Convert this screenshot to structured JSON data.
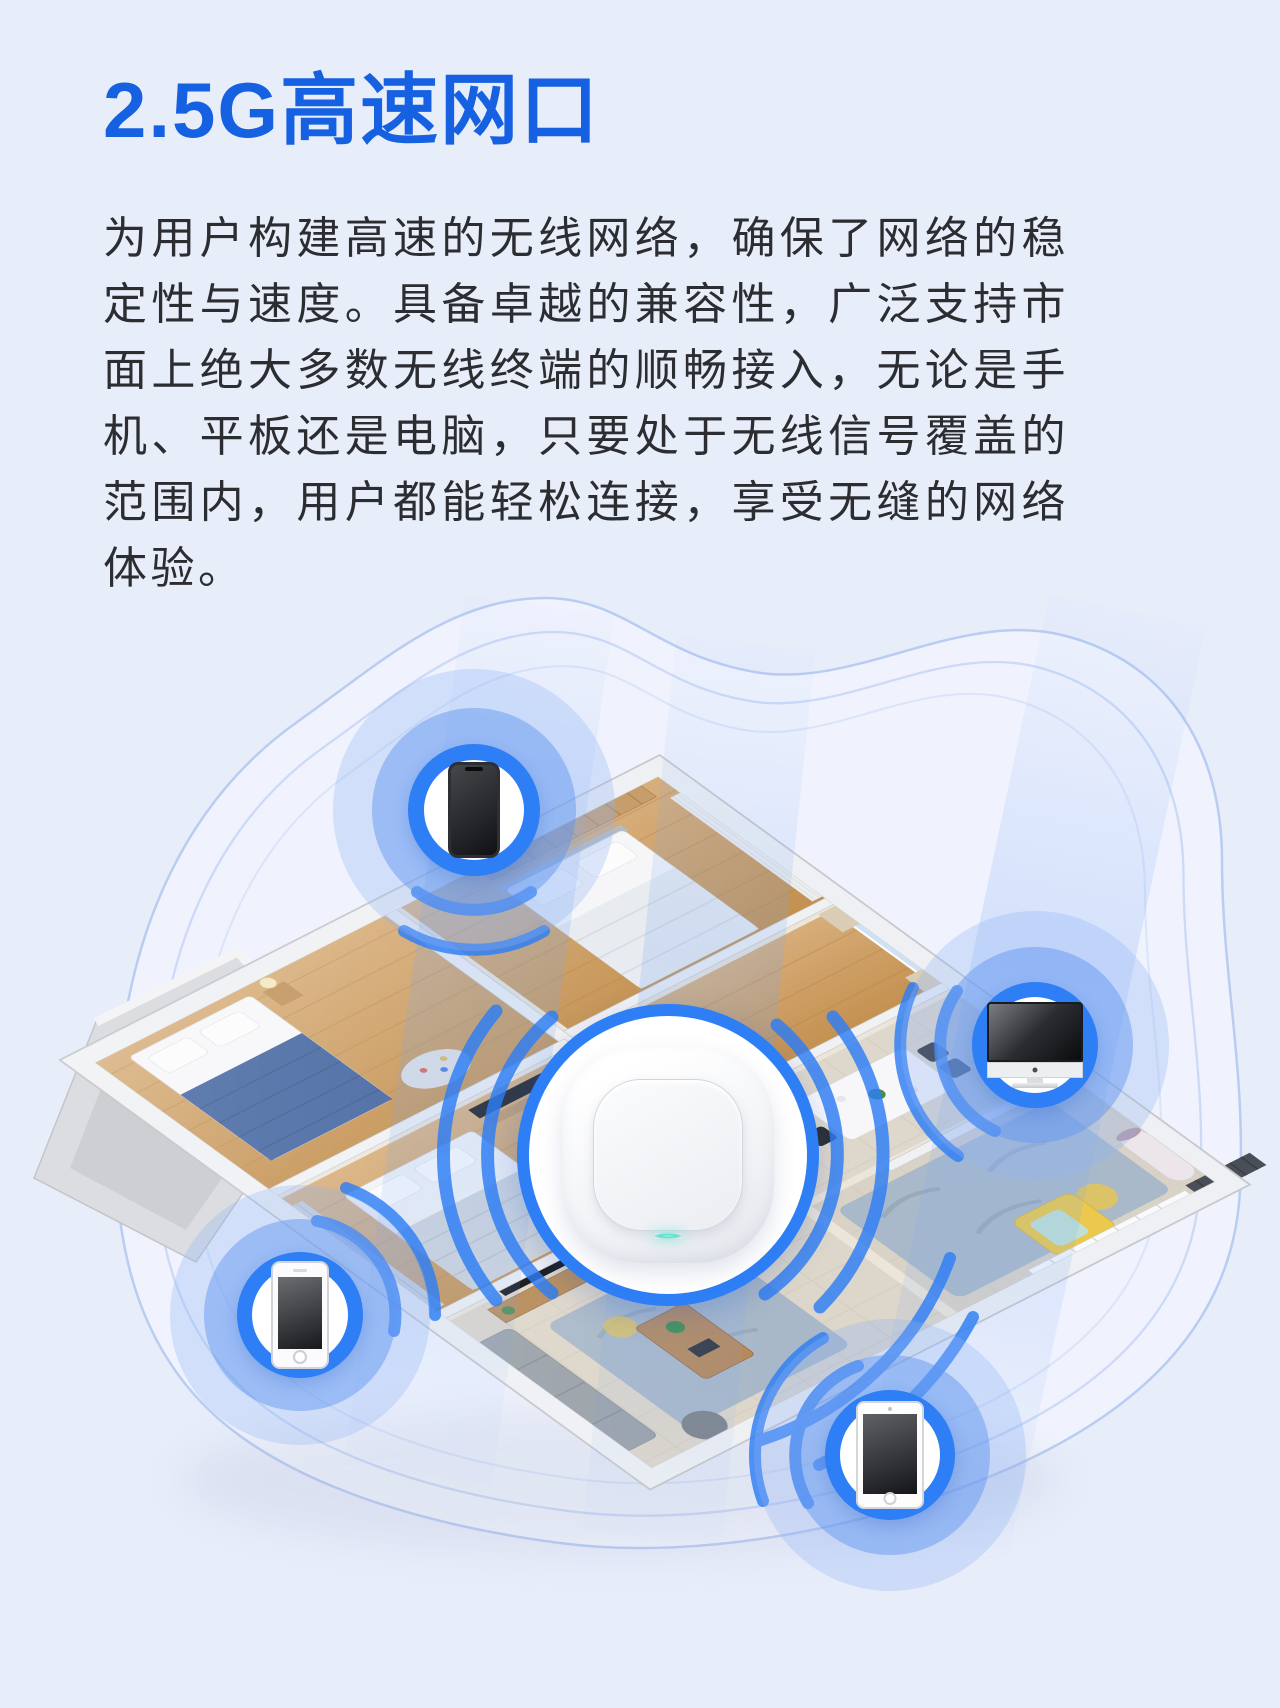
{
  "page": {
    "background": "#e8edfa"
  },
  "header": {
    "title": "2.5G高速网口",
    "title_color": "#1561e1"
  },
  "body": {
    "paragraph": "为用户构建高速的无线网络，确保了网络的稳定性与速度。具备卓越的兼容性，广泛支持市面上绝大多数无线终端的顺畅接入，无论是手机、平板还是电脑，只要处于无线信号覆盖的范围内，用户都能轻松连接，享受无缝的网络体验。",
    "text_color": "#2c2d31"
  },
  "illustration": {
    "accent_blue": "#2e7ef5",
    "wave_line_color": "#b4c9f2",
    "router": {
      "icon": "wireless-ap-icon",
      "led_color": "#5fe8d3"
    },
    "devices": [
      {
        "id": "smartphone",
        "icon": "smartphone-icon"
      },
      {
        "id": "desktop-monitor",
        "icon": "imac-icon"
      },
      {
        "id": "mobile-phone",
        "icon": "iphone-icon"
      },
      {
        "id": "tablet",
        "icon": "tablet-icon"
      }
    ]
  }
}
